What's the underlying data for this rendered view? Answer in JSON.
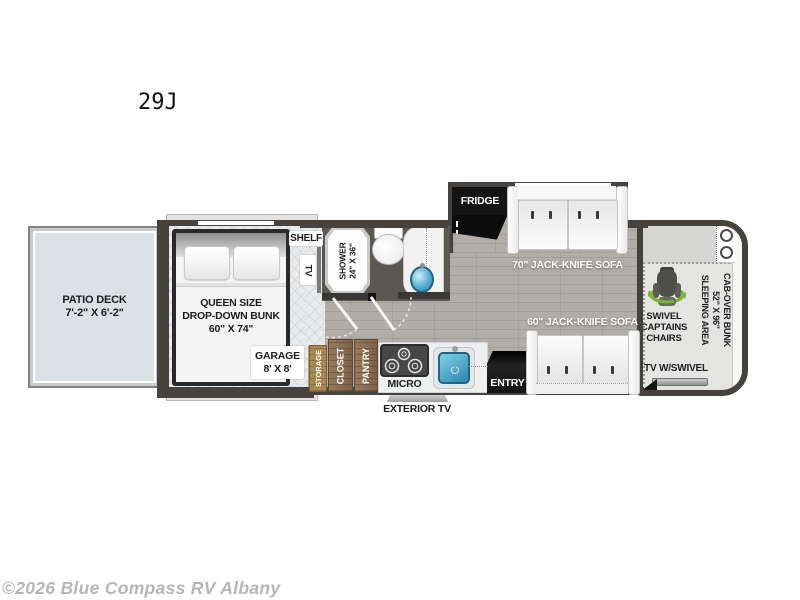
{
  "title": "29J",
  "watermark": "©2026 Blue Compass RV Albany",
  "colors": {
    "swivel_green": "#76b82a",
    "sink_blue": "#3fa3c9",
    "wall_dark": "#454240",
    "wood_cabinet": "#8a6c4e",
    "wood_storage": "#a8894f",
    "deck_blue": "#dbe1e6",
    "floor_gray": "#b1ada8",
    "fridge_black": "#141414"
  },
  "labels": {
    "patio_deck": "PATIO DECK",
    "patio_dims": "7'-2\" X 6'-2\"",
    "bunk_l1": "QUEEN SIZE",
    "bunk_l2": "DROP-DOWN BUNK",
    "bunk_l3": "60\" X 74\"",
    "garage": "GARAGE",
    "garage_dims": "8' X 8'",
    "shelf": "SHELF",
    "tv": "TV",
    "shower_l1": "SHOWER",
    "shower_l2": "24\" X 36\"",
    "storage": "STORAGE",
    "closet": "CLOSET",
    "pantry": "PANTRY",
    "micro": "MICRO",
    "entry": "ENTRY",
    "exterior_tv": "EXTERIOR TV",
    "fridge": "FRIDGE",
    "sofa70": "70\" JACK-KNIFE SOFA",
    "sofa60": "60\" JACK-KNIFE SOFA",
    "cab_bunk_l1": "CAB-OVER BUNK",
    "cab_bunk_l2": "52\" X 96\"",
    "cab_bunk_l3": "SLEEPING AREA",
    "chairs_l1": "SWIVEL",
    "chairs_l2": "CAPTAINS",
    "chairs_l3": "CHAIRS",
    "cab_tv": "TV W/SWIVEL"
  }
}
